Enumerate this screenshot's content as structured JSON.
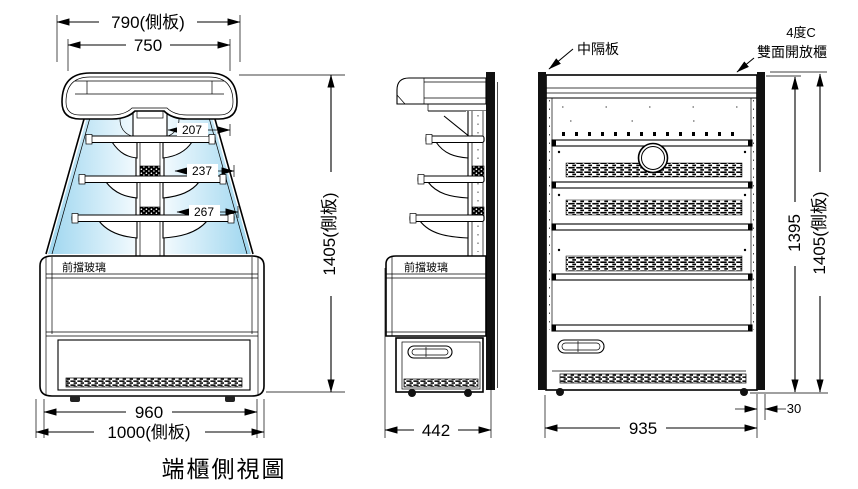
{
  "caption": "端櫃側視圖",
  "colors": {
    "line": "#000000",
    "partition_fill": "#111111",
    "glass_dark": "#9ed6ef",
    "glass_light": "#f2fafe"
  },
  "left_view": {
    "dim_top_outer": "790(側板)",
    "dim_top_inner": "750",
    "dim_shelf_top": "207",
    "dim_shelf_mid": "237",
    "dim_shelf_bottom": "267",
    "dim_height": "1405(側板)",
    "dim_bottom_inner": "960",
    "dim_bottom_outer": "1000(側板)",
    "label_front_glass": "前擋玻璃"
  },
  "middle_view": {
    "dim_width": "442",
    "label_front_glass": "前擋玻璃"
  },
  "right_view": {
    "label_partition": "中隔板",
    "label_temperature": "4度C",
    "label_cabinet": "雙面開放櫃",
    "dim_height_inner": "1395",
    "dim_height_outer": "1405(側板)",
    "dim_width": "935",
    "dim_partition_thickness": "30"
  }
}
